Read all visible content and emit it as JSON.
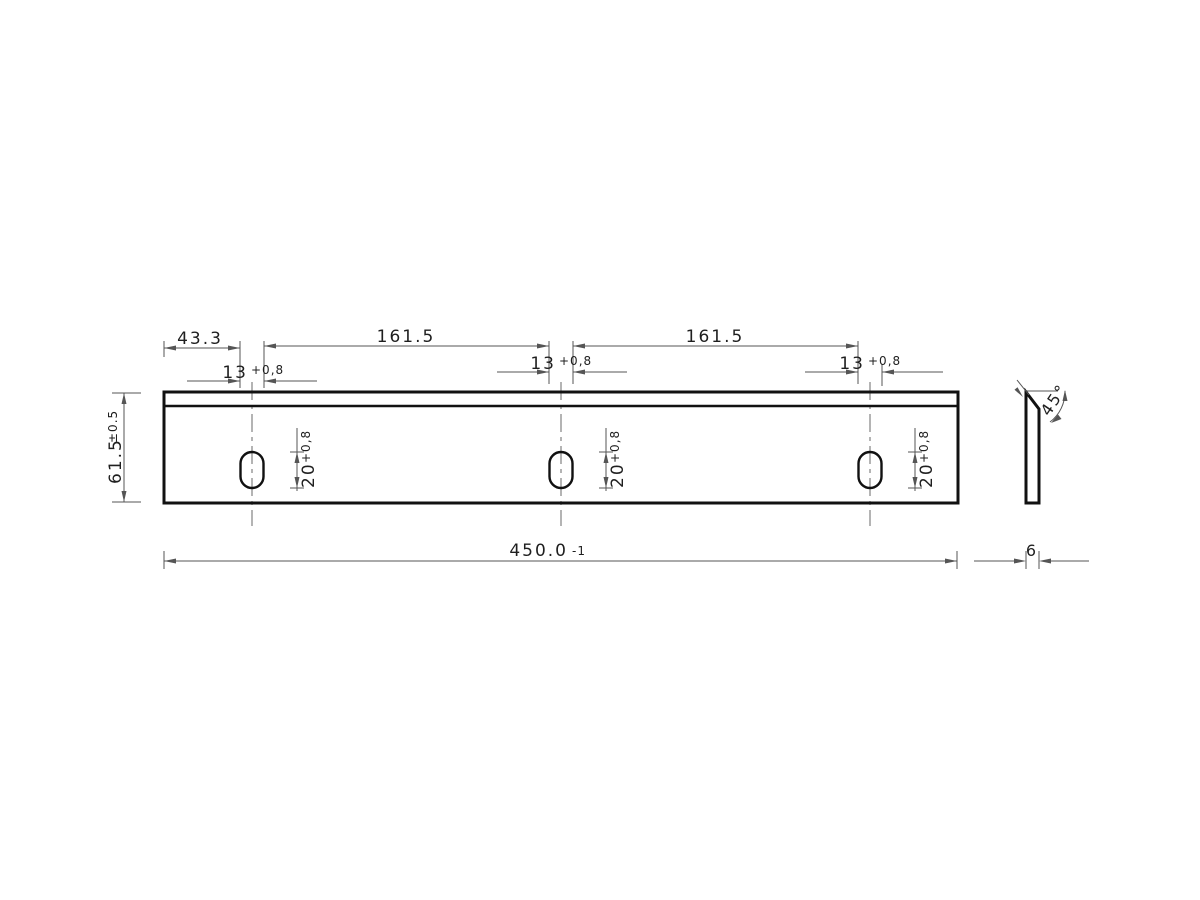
{
  "drawing": {
    "front_view": {
      "offset_left": "43.3",
      "pitch_1": "161.5",
      "pitch_2": "161.5",
      "slot_width": "13",
      "slot_width_tol": "+0,8",
      "slot_height": "20",
      "slot_height_tol": "+0,8",
      "blade_height": "61.5",
      "blade_height_tol": "±0.5",
      "total_length": "450.0",
      "total_length_tol": "-1"
    },
    "side_view": {
      "thickness": "6",
      "chamfer_angle": "45°"
    }
  }
}
